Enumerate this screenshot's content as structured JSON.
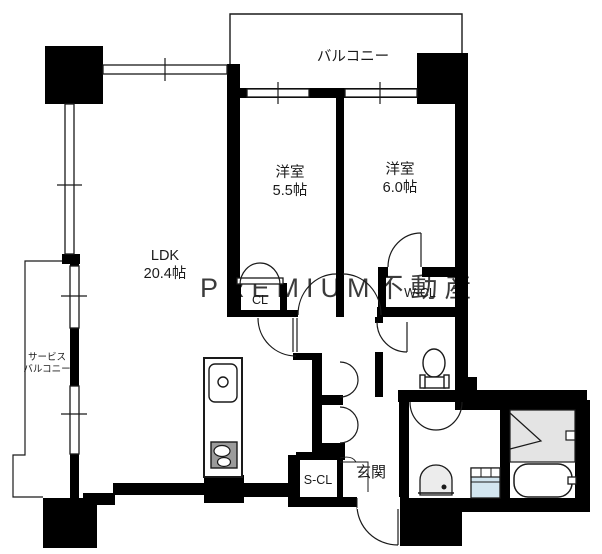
{
  "plan": {
    "type": "floor-plan",
    "watermark": "PREMIUM不動産",
    "colors": {
      "wall": "#000000",
      "background": "#ffffff",
      "shower_floor": "#e4e4e4",
      "stove": "#9b9b9b",
      "wash_pan": "#d3e6f0",
      "fixture_gray": "#ececec",
      "watermark": "#dcdcdc"
    },
    "rooms": {
      "balcony": "バルコニー",
      "bedroom1_name": "洋室",
      "bedroom1_size": "5.5帖",
      "bedroom2_name": "洋室",
      "bedroom2_size": "6.0帖",
      "ldk_name": "LDK",
      "ldk_size": "20.4帖",
      "closet": "CL",
      "walk_in_closet": "W-CL",
      "service_balcony_line1": "サービス",
      "service_balcony_line2": "バルコニー",
      "shoe_closet": "S-CL",
      "entrance": "玄関"
    }
  }
}
